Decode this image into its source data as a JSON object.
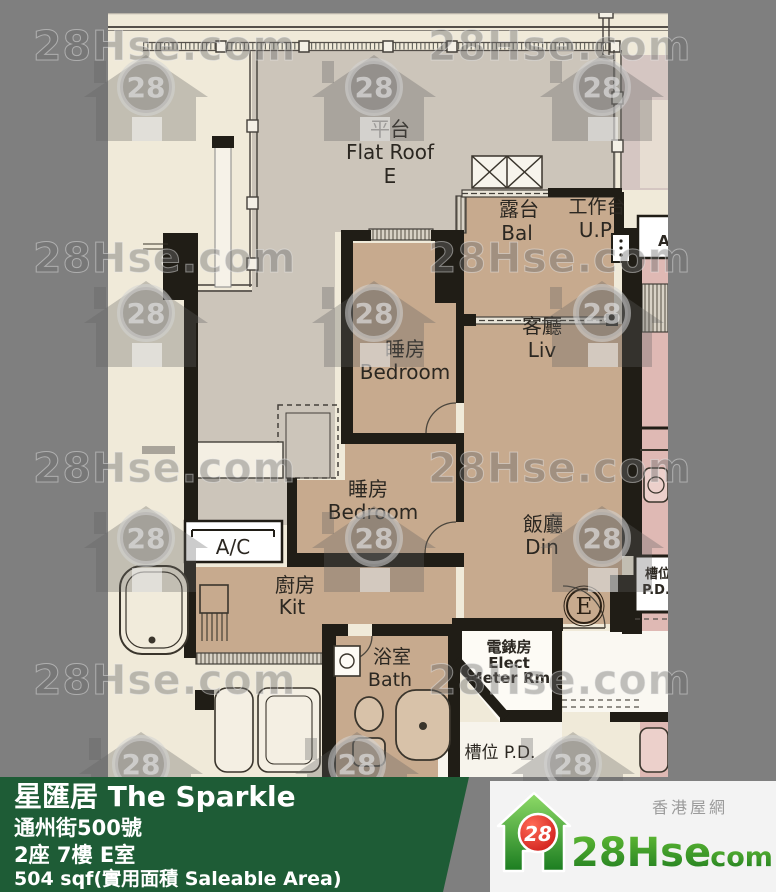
{
  "watermark": {
    "text": "28Hse.com",
    "badge": "28"
  },
  "plan": {
    "rooms": {
      "flat_roof": {
        "zh": "平台",
        "en": "Flat Roof",
        "unit": "E"
      },
      "balcony": {
        "zh": "露台",
        "en": "Bal"
      },
      "utility": {
        "zh": "工作台",
        "en": "U.P."
      },
      "living": {
        "zh": "客廳",
        "en": "Liv"
      },
      "bedroom1": {
        "zh": "睡房",
        "en": "Bedroom"
      },
      "bedroom2": {
        "zh": "睡房",
        "en": "Bedroom"
      },
      "dining": {
        "zh": "飯廳",
        "en": "Din"
      },
      "kitchen": {
        "zh": "廚房",
        "en": "Kit"
      },
      "bath": {
        "zh": "浴室",
        "en": "Bath"
      },
      "elect": {
        "zh": "電錶房",
        "en1": "Elect",
        "en2": "Meter Rm"
      },
      "ac": {
        "label": "A/C"
      },
      "ac_neighbor": {
        "label": "A/C"
      },
      "pd_right": {
        "zh": "槽位",
        "en": "P.D."
      },
      "pd_bottom": {
        "label": "槽位 P.D."
      },
      "unit_marker": "E"
    }
  },
  "footer": {
    "building_name": "星匯居 The Sparkle",
    "address": "通州街500號",
    "unit": "2座 7樓 E室",
    "area": "504 sqf(實用面積 Saleable Area)"
  },
  "brand": {
    "tagline": "香港屋網",
    "site_main": "28Hse",
    "site_tld": ".com",
    "badge": "28"
  },
  "colors": {
    "border_gray": "#7f7f7f",
    "paper": "#f0ead9",
    "flat_roof": "#ccc5ba",
    "interior_tan": "#c7aa8e",
    "neighbor_pink": "#dfb9b4",
    "wall_black": "#201d16",
    "footer_green": "#1e5c36",
    "panel_gray": "#f3f3f3",
    "logo_green": "#2e8f2e",
    "logo_red": "#d62020"
  }
}
